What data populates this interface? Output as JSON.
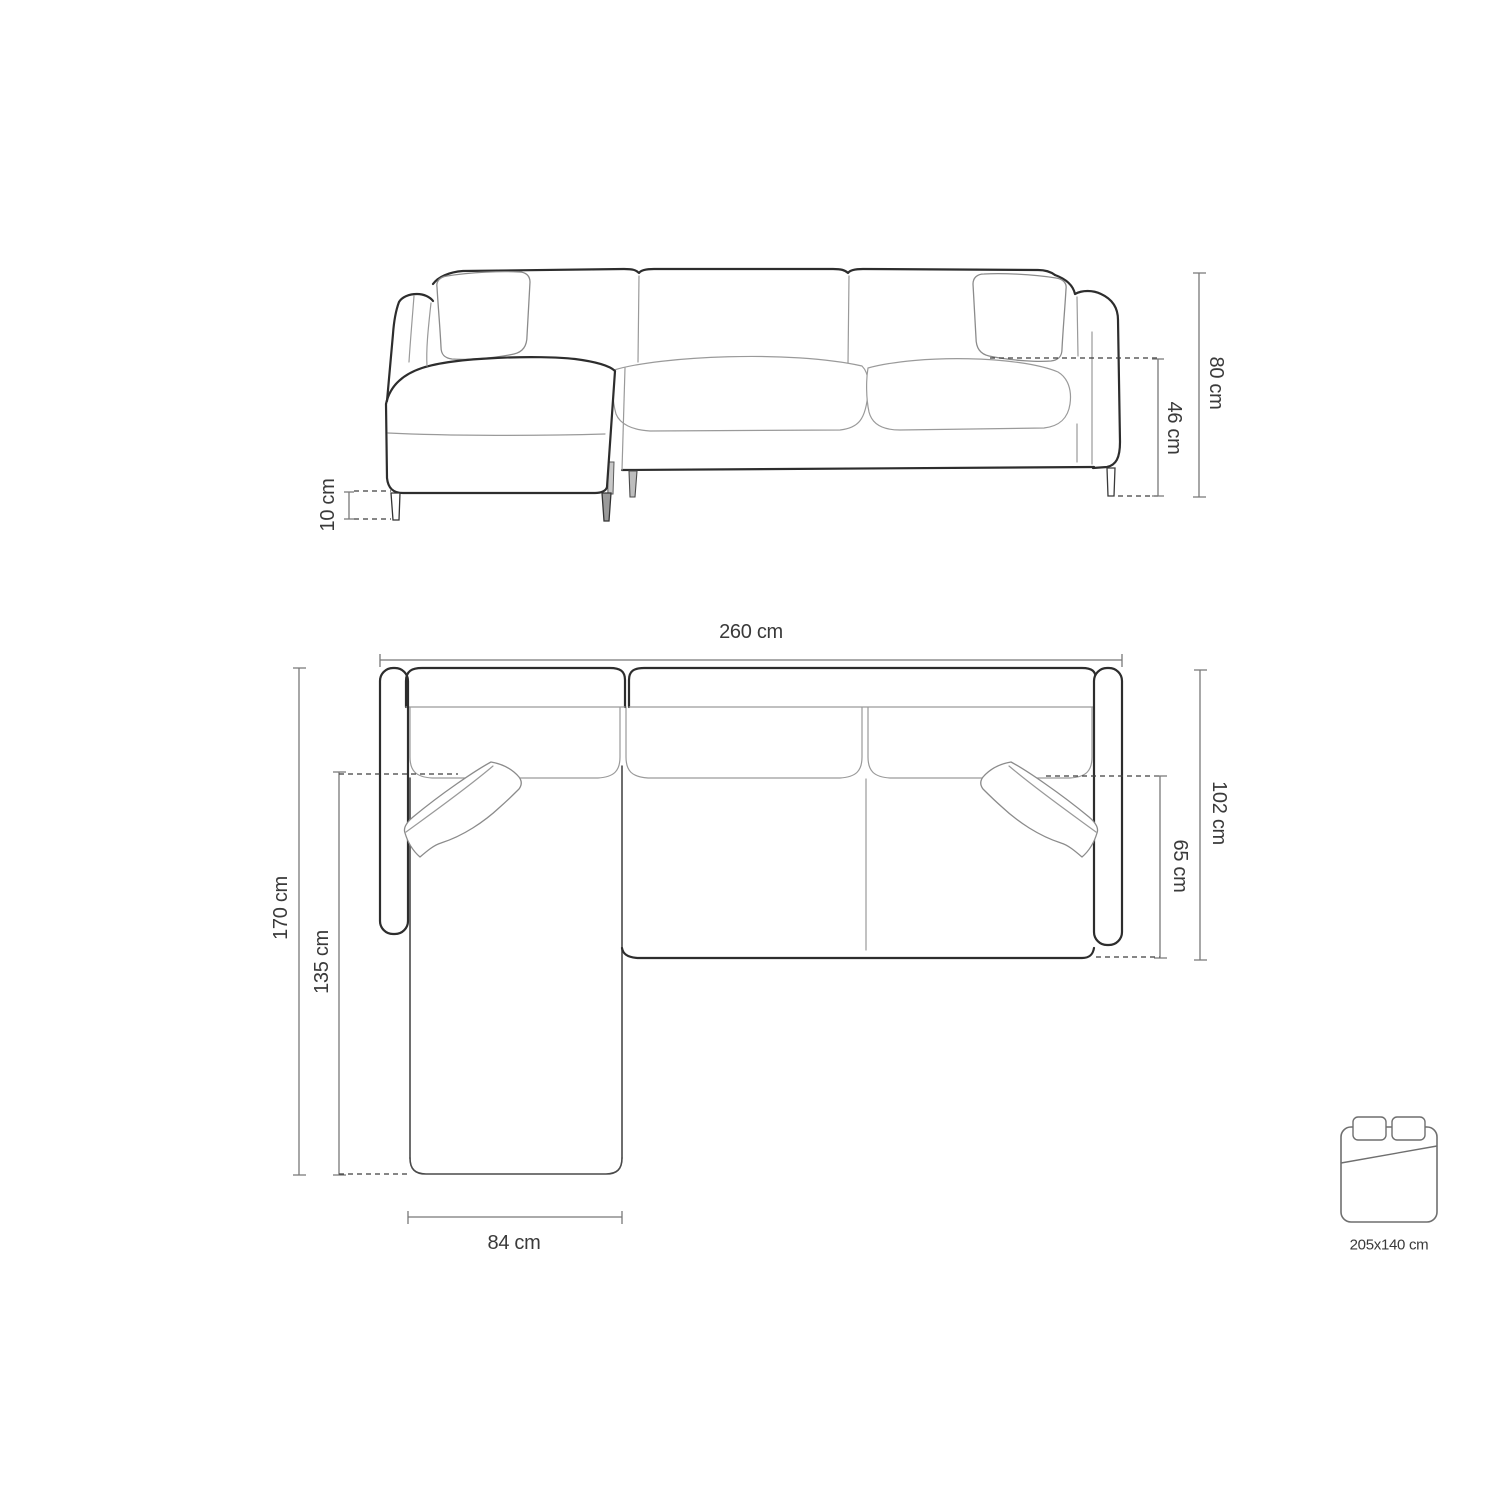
{
  "diagram": {
    "front_view": {
      "overall_height_label": "80 cm",
      "seat_height_label": "46 cm",
      "leg_height_label": "10 cm"
    },
    "top_view": {
      "overall_width_label": "260 cm",
      "overall_depth_label": "170 cm",
      "chaise_depth_label": "135 cm",
      "body_depth_label": "102 cm",
      "seat_depth_label": "65 cm",
      "chaise_width_label": "84 cm"
    },
    "sleeping_area": {
      "size_label": "205x140 cm"
    },
    "colors": {
      "background": "#ffffff",
      "outline_dark": "#2d2d2d",
      "outline_light": "#9a9a9a",
      "dimension_line": "#787878",
      "text": "#3a3a3a"
    }
  }
}
